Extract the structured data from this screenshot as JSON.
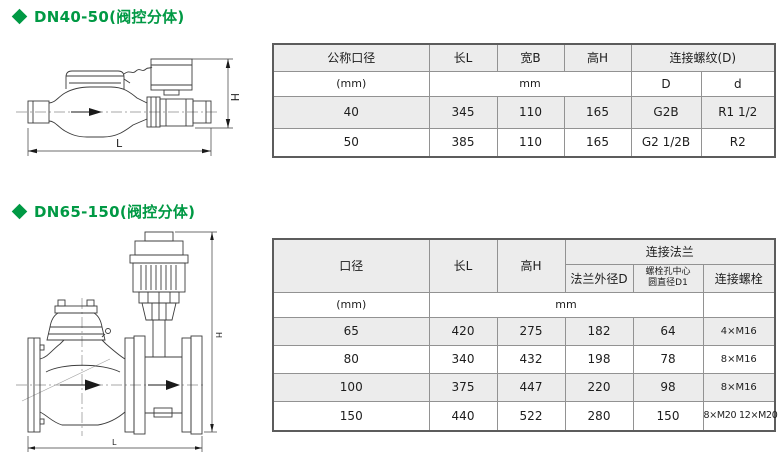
{
  "page": {
    "accent_green": "#009944",
    "row_shade_gray": "#ececec"
  },
  "section1": {
    "title": "DN40-50(阀控分体)",
    "drawing": {
      "length_label": "L",
      "height_label": "H"
    },
    "table": {
      "col_headers": {
        "nominal_diameter": "公称口径",
        "length": "长L",
        "width": "宽B",
        "height": "高H",
        "thread_group": "连接螺纹(D)",
        "thread_D": "D",
        "thread_d": "d"
      },
      "unit_row": {
        "diameter_unit": "(mm)",
        "dims_unit": "mm"
      },
      "rows": [
        {
          "dn": "40",
          "l": "345",
          "b": "110",
          "h": "165",
          "D": "G2B",
          "d": "R1 1/2"
        },
        {
          "dn": "50",
          "l": "385",
          "b": "110",
          "h": "165",
          "D": "G2 1/2B",
          "d": "R2"
        }
      ]
    }
  },
  "section2": {
    "title": "DN65-150(阀控分体)",
    "drawing": {
      "length_label": "L",
      "height_label": "H"
    },
    "table": {
      "col_headers": {
        "diameter": "口径",
        "length": "长L",
        "height": "高H",
        "flange_group": "连接法兰",
        "flange_od": "法兰外径D",
        "bolt_circle_line1": "螺栓孔中心",
        "bolt_circle_line2": "圆直径D1",
        "bolts": "连接螺栓"
      },
      "unit_row": {
        "diameter_unit": "(mm)",
        "dims_unit": "mm"
      },
      "rows": [
        {
          "dn": "65",
          "l": "420",
          "h": "275",
          "flange_od": "182",
          "bolt_circle": "64",
          "bolts": "4×M16"
        },
        {
          "dn": "80",
          "l": "340",
          "h": "432",
          "flange_od": "198",
          "bolt_circle": "78",
          "bolts": "8×M16"
        },
        {
          "dn": "100",
          "l": "375",
          "h": "447",
          "flange_od": "220",
          "bolt_circle": "98",
          "bolts": "8×M16"
        },
        {
          "dn": "150",
          "l": "440",
          "h": "522",
          "flange_od": "280",
          "bolt_circle": "150",
          "bolts": "8×M20 12×M20"
        }
      ]
    }
  }
}
